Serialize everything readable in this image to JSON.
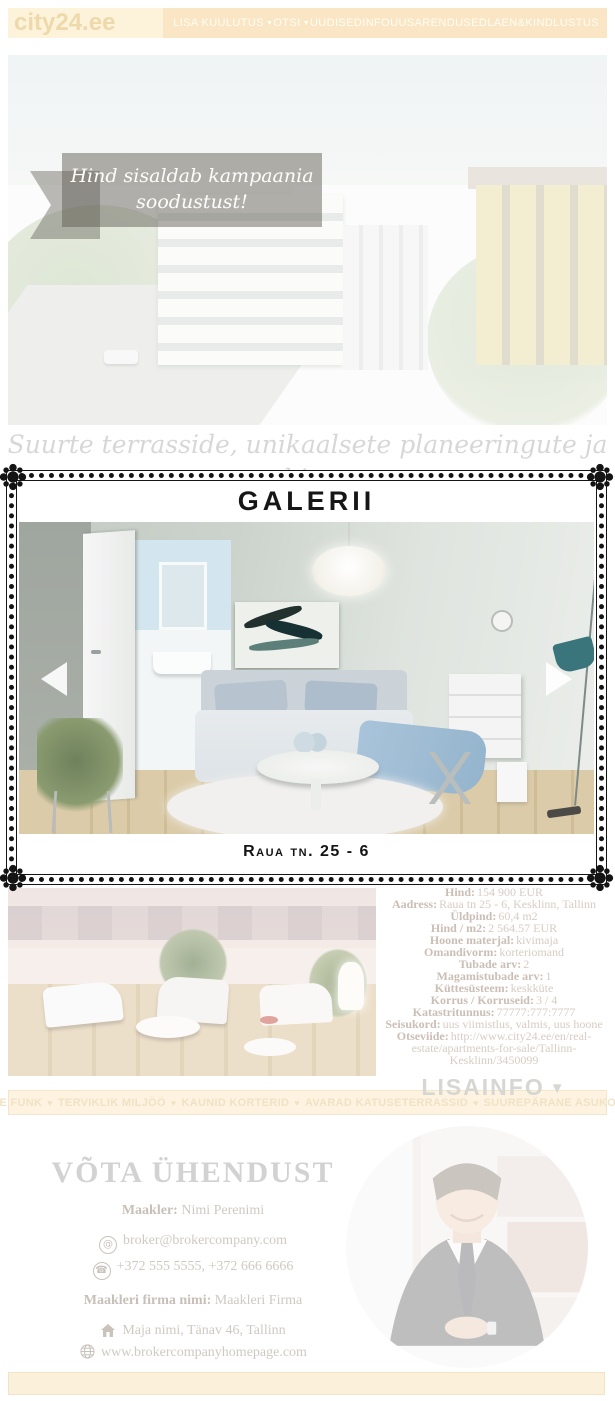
{
  "navbar": {
    "logo": "city24.ee",
    "dropdown_caret": "▼",
    "items": [
      {
        "label": "LISA KUULUTUS",
        "dropdown": true
      },
      {
        "label": "OTSI",
        "dropdown": true
      },
      {
        "label": "UUDISED",
        "dropdown": false
      },
      {
        "label": "INFO",
        "dropdown": false
      },
      {
        "label": "UUSARENDUSED",
        "dropdown": false
      },
      {
        "label": "LAEN&KINDLUSTUS",
        "dropdown": false
      }
    ]
  },
  "hero": {
    "ribbon_text": "Hind sisaldab kampaania soodustust!"
  },
  "tagline": {
    "line1": "Suurte terrasside, unikaalsete planeeringute ja hin-",
    "line2": "nalise siseviimistlusega korterid ühes 1930ndate"
  },
  "gallery": {
    "title": "GALERII",
    "caption": "Raua tn. 25 - 6"
  },
  "details": {
    "rows": [
      {
        "label": "Kinnisvara liik:",
        "value": "korter"
      },
      {
        "label": "Hind:",
        "value": "154 900 EUR"
      },
      {
        "label": "Aadress:",
        "value": "Raua tn 25 - 6, Kesklinn, Tallinn"
      },
      {
        "label": "Üldpind:",
        "value": "60,4 m2"
      },
      {
        "label": "Hind / m2:",
        "value": "2 564.57 EUR"
      },
      {
        "label": "Hoone materjal:",
        "value": "kivimaja"
      },
      {
        "label": "Omandivorm:",
        "value": "korteriomand"
      },
      {
        "label": "Tubade arv:",
        "value": "2"
      },
      {
        "label": "Magamistubade arv:",
        "value": "1"
      },
      {
        "label": "Küttesüsteem:",
        "value": "keskküte"
      },
      {
        "label": "Korrus / Korruseid:",
        "value": "3 / 4"
      },
      {
        "label": "Katastritunnus:",
        "value": "77777:777:7777"
      },
      {
        "label": "Seisukord:",
        "value": "uus viimistlus, valmis, uus hoone"
      },
      {
        "label": "Otseviide:",
        "value": "http://www.city24.ee/en/real-estate/apartments-for-sale/Tallinn-Kesklinn/3450099"
      }
    ],
    "more_label": "LISAINFO",
    "more_caret": "▼"
  },
  "features": {
    "separator": "♥",
    "items": [
      "EHE FUNK",
      "TERVIKLIK MILJÖÖ",
      "KAUNID KORTERID",
      "AVARAD KATUSETERRASSID",
      "SUUREPÄRANE ASUKOHT"
    ]
  },
  "contact": {
    "title": "VÕTA ÜHENDUST",
    "broker_label": "Maakler:",
    "broker_name": "Nimi Perenimi",
    "email": "broker@brokercompany.com",
    "phones": "+372 555 5555, +372 666 6666",
    "company_label": "Maakleri firma nimi:",
    "company_name": "Maakleri Firma",
    "address": "Maja nimi, Tänav 46, Tallinn",
    "website": "www.brokercompanyhomepage.com"
  },
  "icons": {
    "email_glyph": "@",
    "phone_glyph": "☎"
  },
  "colors": {
    "navbar_cream": "#fae6c4",
    "logo_panel": "#fdf2da",
    "frame_black": "#141414",
    "faded_label": "#cbbeb4",
    "faded_value": "#d7ccc3",
    "muted_gray": "#d6d6d3",
    "feature_text": "#efe3c5",
    "accent_teal": "#3a757c"
  }
}
